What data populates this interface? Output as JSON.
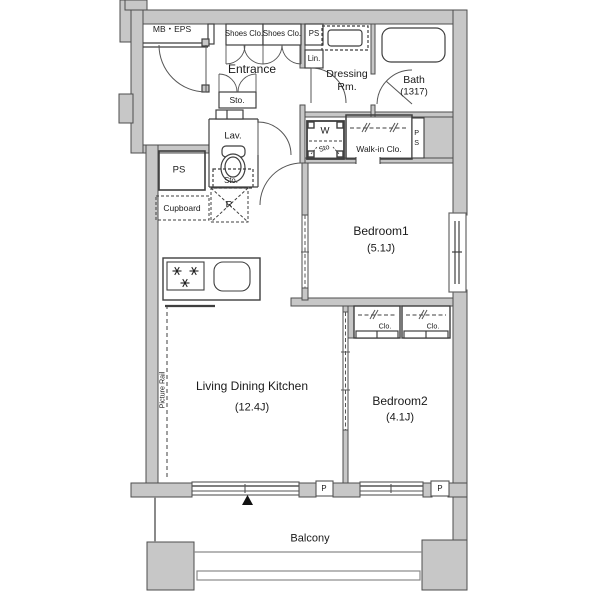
{
  "title": "Apartment floor plan",
  "colors": {
    "background": "#ffffff",
    "wall_fill": "#c7c7c7",
    "wall_stroke": "#4d4d4d",
    "line": "#3f3f3f",
    "text": "#1a1a1a"
  },
  "rooms": {
    "mb_eps": {
      "label": "MB・EPS"
    },
    "entrance": {
      "label": "Entrance"
    },
    "dressing_room": {
      "name": "Dressing",
      "suffix": "Rm."
    },
    "bath": {
      "name": "Bath",
      "size": "(1317)"
    },
    "lavatory": {
      "label": "Lav."
    },
    "walk_in_closet": {
      "label": "Walk-in Clo."
    },
    "bedroom1": {
      "name": "Bedroom1",
      "size": "(5.1J)"
    },
    "bedroom2": {
      "name": "Bedroom2",
      "size": "(4.1J)"
    },
    "living_dining_kitchen": {
      "name": "Living Dining Kitchen",
      "size": "(12.4J)"
    },
    "balcony": {
      "label": "Balcony"
    }
  },
  "fixtures": {
    "shoes_closet_left": "Shoes Clo.",
    "shoes_closet_right": "Shoes Clo.",
    "pipe_space_entrance": "PS",
    "linen_cabinet": "Lin.",
    "entrance_storage": "Sto.",
    "lavatory_storage": "Sto.",
    "washer": "W",
    "washer_storage": "Sto",
    "pipe_space_walkin": "PS",
    "pipe_space_kitchen": "PS",
    "cupboard": "Cupboard",
    "refrigerator": "R",
    "closet_left": "Clo.",
    "closet_right": "Clo.",
    "picture_rail": "Picture Rail",
    "pipe_left": "P",
    "pipe_right": "P"
  }
}
